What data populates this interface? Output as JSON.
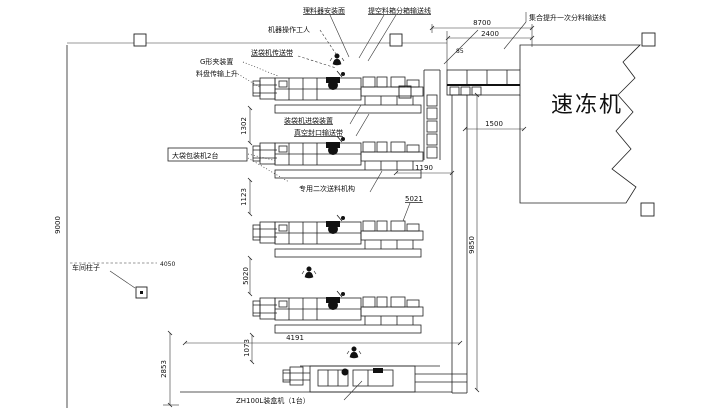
{
  "colors": {
    "background": "#ffffff",
    "line": "#222222",
    "text": "#111111"
  },
  "labels": {
    "freezer": "速冻机",
    "top_label_1": "理料器安装面",
    "top_label_2": "提空料箱分箱输送线",
    "operator": "机器操作工人",
    "bag_feeder": "送袋机传送带",
    "g_clamp": "G形夹装置",
    "tray_lift": "料盘传输上升",
    "bag_infeed": "装袋机进袋装置",
    "vacuum_seal": "真空封口输送带",
    "packer_box": "大袋包装机2台",
    "secondary_feed": "专用二次送料机构",
    "freezer_infeed": "集合提升一次分料输送线",
    "column_note": "车间柱子",
    "col_mark": "5021",
    "case_packer": "ZH100L装盒机（1台）"
  },
  "dimensions": {
    "left_height": "9000",
    "top_total": "8700",
    "top_inner": "2400",
    "small_offset": "85",
    "infeed_width": "1500",
    "lane_length": "9850",
    "gap_1": "1302",
    "gap_2": "1123",
    "row3_offset": "1190",
    "gap_3": "5020",
    "gap_4": "1073",
    "bottom_left": "2853",
    "door_offset": "4050",
    "row4_length": "4191"
  }
}
